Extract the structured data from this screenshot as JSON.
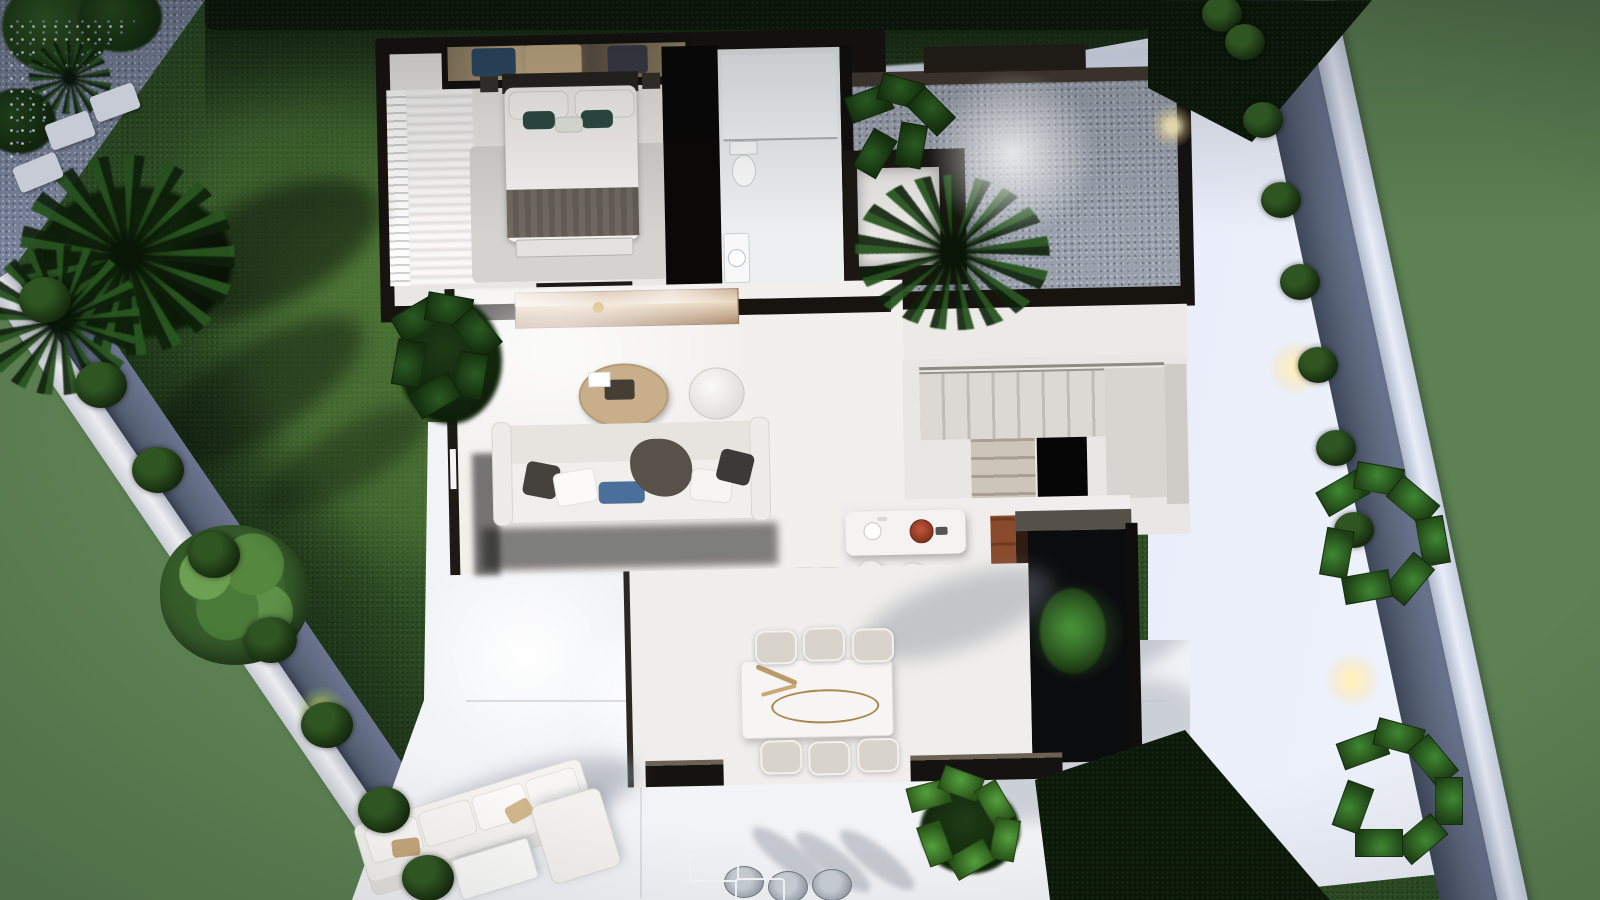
{
  "image": {
    "kind": "3D architectural floor-plan render",
    "view": "top-down aerial",
    "lighting": "dusk with interior and garden lights",
    "width_px": 1600,
    "height_px": 900
  },
  "palette": {
    "surround_green": "#5d8153",
    "lawn": "#2e4e25",
    "gravel_blue": "#7e88a0",
    "side_path": "#dbe4f2",
    "boundary_wall": "#e7eaf0",
    "house_wall_dark": "#17130f",
    "interior_floor": "#f1f0ed",
    "wood_cabinet": "#8a4a2c",
    "teal_pillow": "#2e4c42",
    "blue_pillow": "#4a6f9b",
    "terracotta_dish": "#a5402a",
    "bronze_console": "#c9a98b",
    "warm_glow": "#ffe9b0"
  },
  "scene": {
    "label": "Villa ground-floor plan render with garden",
    "garden": {
      "label": "Walled garden",
      "lawn_label": "Lawn",
      "left_wall_label": "Left boundary wall with gravel bed and box hedges",
      "right_wall_label": "Right boundary wall with gravel bed, box hedges and plants",
      "side_path_label": "Light stone side path",
      "corner_label": "Gravel corner planting with flowers and stepping stones",
      "palm_label": "Palm trees",
      "tree_label": "Garden tree",
      "hedge_top_label": "Dark hedge along top boundary",
      "hedge_bottom_label": "Hedge at lower right",
      "lights_label": "Garden spot lights",
      "counts": {
        "left_bushes": 8,
        "right_bushes": 8,
        "stepping_stones": 3
      }
    },
    "house": {
      "label": "Single-storey villa interior",
      "rooms": [
        {
          "id": "bedroom",
          "label": "Master bedroom"
        },
        {
          "id": "bathroom",
          "label": "Bathroom"
        },
        {
          "id": "entry",
          "label": "Entry vestibule"
        },
        {
          "id": "courtyard",
          "label": "Entrance gravel courtyard with palm"
        },
        {
          "id": "living",
          "label": "Living room"
        },
        {
          "id": "stairs",
          "label": "Staircase with void"
        },
        {
          "id": "kitchen",
          "label": "Kitchen with island"
        },
        {
          "id": "patio",
          "label": "Interior dark patio with lit plant"
        },
        {
          "id": "dining",
          "label": "Dining area"
        }
      ],
      "furniture": {
        "bed_label": "Double bed with teal pillows and grey throw",
        "wardrobe_label": "Wardrobe with clothes",
        "rug_label": "Bedroom rug",
        "toilet_label": "Toilet",
        "shower_label": "Walk-in shower",
        "basin_label": "Washbasin",
        "console_label": "Bronze console sideboard",
        "coffee_table_label": "Round wooden coffee table",
        "pouf_label": "White pouf",
        "sofa_label": "White sofa with cushions",
        "island_label": "Kitchen island with sink and terracotta dish",
        "stools_label": "Bar stools",
        "cabinet_label": "Tall walnut cabinets",
        "dining_table_label": "Marble dining table with botanical decor",
        "dining_chairs_label": "Dining chairs",
        "counts": {
          "dining_chairs": 6,
          "bar_stools": 2,
          "bed_pillows": 5
        }
      }
    },
    "terrace": {
      "label": "White outdoor terrace",
      "sofa_label": "Outdoor lounge sofa",
      "chaise_label": "Outdoor chaise",
      "table_label": "Outdoor coffee table",
      "chairs_label": "Outdoor dining chairs",
      "plant_label": "Terrace plants",
      "counts": {
        "outdoor_chairs": 3
      }
    }
  }
}
